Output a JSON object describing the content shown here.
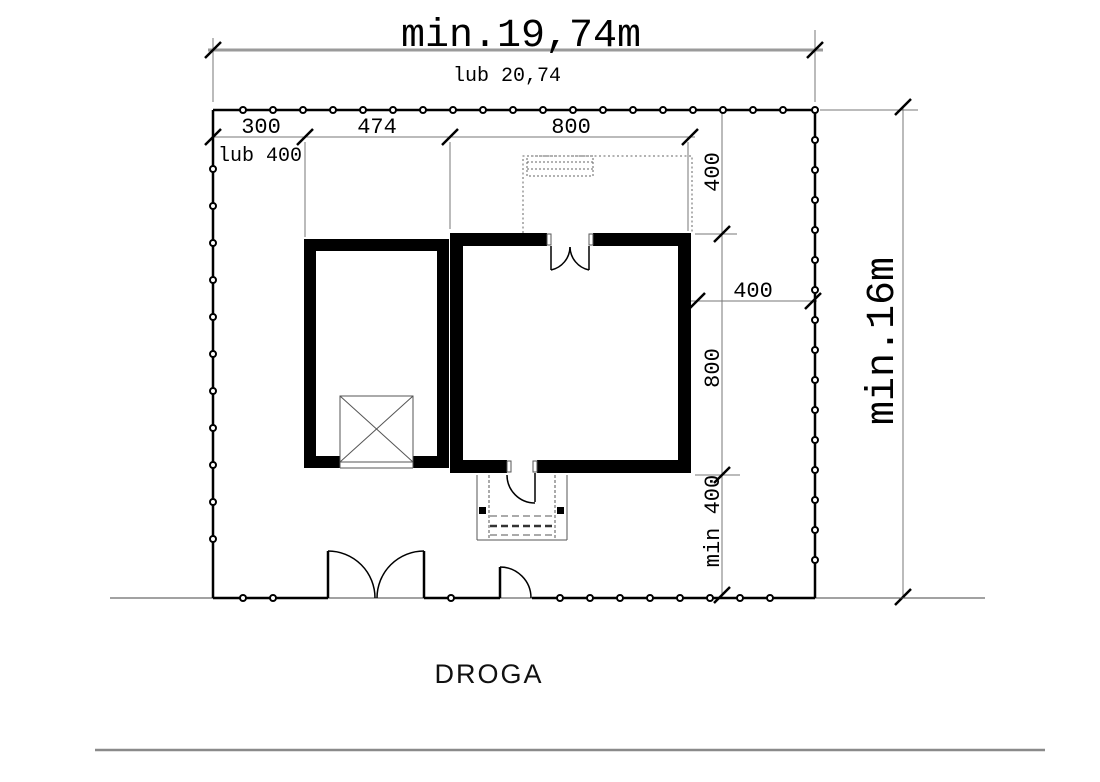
{
  "dimensions": {
    "plot_width": {
      "main": "min.19,74m",
      "alt": "lub 20,74"
    },
    "plot_depth": "min.16m",
    "setback_left": {
      "value": "300",
      "alt": "lub 400"
    },
    "garage_width": "474",
    "house_width": "800",
    "setback_north": "400",
    "setback_east": "400",
    "house_depth": "800",
    "setback_south": "min 400"
  },
  "labels": {
    "road": "DROGA"
  },
  "colors": {
    "ink": "#000000",
    "dim_gray": "#9a9a9a",
    "thin_line": "#777777",
    "background": "#ffffff"
  }
}
